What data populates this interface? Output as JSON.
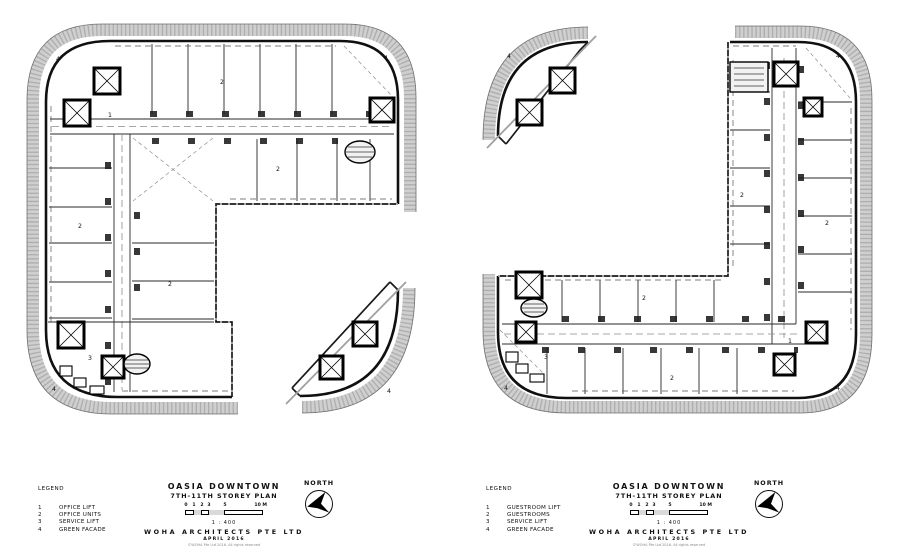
{
  "plans": {
    "left": {
      "marks": {
        "office_lift": "1",
        "office_units": "2",
        "service_lift": "3",
        "green_facade": "4"
      }
    },
    "right": {
      "marks": {
        "guestroom_lift": "1",
        "guestrooms": "2",
        "service_lift": "3",
        "green_facade": "4"
      }
    }
  },
  "footers": {
    "left": {
      "legend_title": "LEGEND",
      "legend": [
        {
          "num": "1",
          "label": "OFFICE LIFT"
        },
        {
          "num": "2",
          "label": "OFFICE UNITS"
        },
        {
          "num": "3",
          "label": "SERVICE LIFT"
        },
        {
          "num": "4",
          "label": "GREEN FACADE"
        }
      ],
      "project": "OASIA DOWNTOWN",
      "sheet": "7TH-11TH STOREY PLAN",
      "scale_ticks": [
        "0",
        "1",
        "2",
        "3",
        "5"
      ],
      "scale_end": "10 M",
      "scale_ratio": "1 : 400",
      "firm": "WOHA ARCHITECTS PTE LTD",
      "date": "APRIL 2016",
      "copyright": "©WOHA Pte Ltd 2016. All rights reserved",
      "north_label": "NORTH"
    },
    "right": {
      "legend_title": "LEGEND",
      "legend": [
        {
          "num": "1",
          "label": "GUESTROOM LIFT"
        },
        {
          "num": "2",
          "label": "GUESTROOMS"
        },
        {
          "num": "3",
          "label": "SERVICE LIFT"
        },
        {
          "num": "4",
          "label": "GREEN FACADE"
        }
      ],
      "project": "OASIA DOWNTOWN",
      "sheet": "7TH-11TH STOREY PLAN",
      "scale_ticks": [
        "0",
        "1",
        "2",
        "3",
        "5"
      ],
      "scale_end": "10 M",
      "scale_ratio": "1 : 400",
      "firm": "WOHA ARCHITECTS PTE LTD",
      "date": "APRIL 2016",
      "copyright": "©WOHA Pte Ltd 2016. All rights reserved",
      "north_label": "NORTH"
    }
  },
  "colors": {
    "paper": "#ffffff",
    "ink": "#101010",
    "facade_band": "#cfcfcf",
    "diagonal": "#a0a0a0"
  }
}
